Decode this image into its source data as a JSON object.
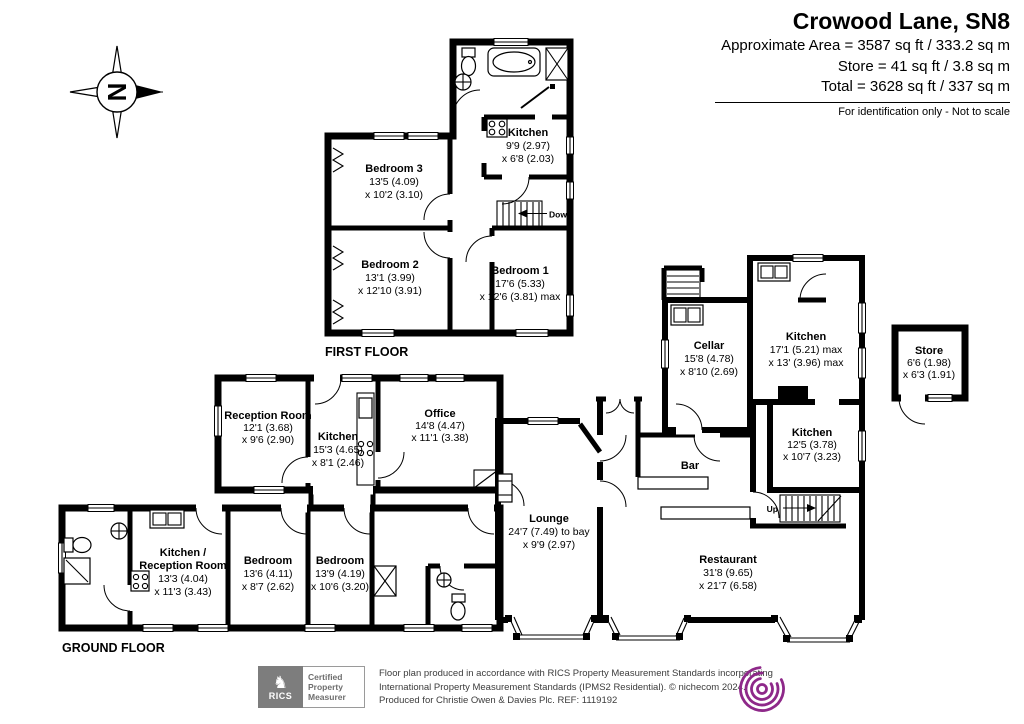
{
  "header": {
    "title": "Crowood Lane, SN8",
    "area_line1": "Approximate Area = 3587 sq ft / 333.2 sq m",
    "area_line2": "Store = 41 sq ft / 3.8 sq m",
    "area_line3": "Total = 3628 sq ft / 337 sq m",
    "note": "For identification only - Not to scale"
  },
  "compass": {
    "north": "N"
  },
  "first_floor": {
    "label": "FIRST FLOOR",
    "stair_label": "Down",
    "rooms": {
      "kitchen": {
        "name": "Kitchen",
        "dim1": "9'9 (2.97)",
        "dim2": "x 6'8 (2.03)"
      },
      "bedroom3": {
        "name": "Bedroom 3",
        "dim1": "13'5 (4.09)",
        "dim2": "x 10'2 (3.10)"
      },
      "bedroom2": {
        "name": "Bedroom 2",
        "dim1": "13'1 (3.99)",
        "dim2": "x 12'10 (3.91)"
      },
      "bedroom1": {
        "name": "Bedroom 1",
        "dim1": "17'6 (5.33)",
        "dim2": "x 12'6 (3.81) max"
      }
    }
  },
  "ground_floor": {
    "label": "GROUND FLOOR",
    "stair_label": "Up",
    "rooms": {
      "reception": {
        "name": "Reception Room",
        "dim1": "12'1 (3.68)",
        "dim2": "x 9'6 (2.90)"
      },
      "kitchen_mid": {
        "name": "Kitchen",
        "dim1": "15'3 (4.65)",
        "dim2": "x 8'1 (2.46)"
      },
      "office": {
        "name": "Office",
        "dim1": "14'8 (4.47)",
        "dim2": "x 11'1 (3.38)"
      },
      "kitchen_reception": {
        "name1": "Kitchen /",
        "name2": "Reception Room",
        "dim1": "13'3 (4.04)",
        "dim2": "x 11'3 (3.43)"
      },
      "bedroom_a": {
        "name": "Bedroom",
        "dim1": "13'6 (4.11)",
        "dim2": "x 8'7 (2.62)"
      },
      "bedroom_b": {
        "name": "Bedroom",
        "dim1": "13'9 (4.19)",
        "dim2": "x 10'6 (3.20)"
      },
      "lounge": {
        "name": "Lounge",
        "dim1": "24'7 (7.49) to bay",
        "dim2": "x 9'9 (2.97)"
      },
      "bar": {
        "name": "Bar"
      },
      "restaurant": {
        "name": "Restaurant",
        "dim1": "31'8 (9.65)",
        "dim2": "x 21'7 (6.58)"
      },
      "cellar": {
        "name": "Cellar",
        "dim1": "15'8 (4.78)",
        "dim2": "x 8'10 (2.69)"
      },
      "kitchen_right": {
        "name": "Kitchen",
        "dim1": "17'1 (5.21) max",
        "dim2": "x 13' (3.96) max"
      },
      "kitchen_lower": {
        "name": "Kitchen",
        "dim1": "12'5 (3.78)",
        "dim2": "x 10'7 (3.23)"
      },
      "store": {
        "name": "Store",
        "dim1": "6'6 (1.98)",
        "dim2": "x 6'3 (1.91)"
      }
    }
  },
  "footer": {
    "rics_label": "RICS",
    "badge": {
      "line1": "Certified",
      "line2": "Property",
      "line3": "Measurer"
    },
    "disclaimer_line1": "Floor plan produced in accordance with RICS Property Measurement Standards incorporating",
    "disclaimer_line2": "International Property Measurement Standards (IPMS2 Residential).   © nichecom 2024.",
    "disclaimer_line3": "Produced for Christie Owen & Davies Plc.   REF:  1119192"
  },
  "colors": {
    "wall": "#000000",
    "nichecom_purple": "#8e2889",
    "rics_gray": "#7d7d7d"
  }
}
